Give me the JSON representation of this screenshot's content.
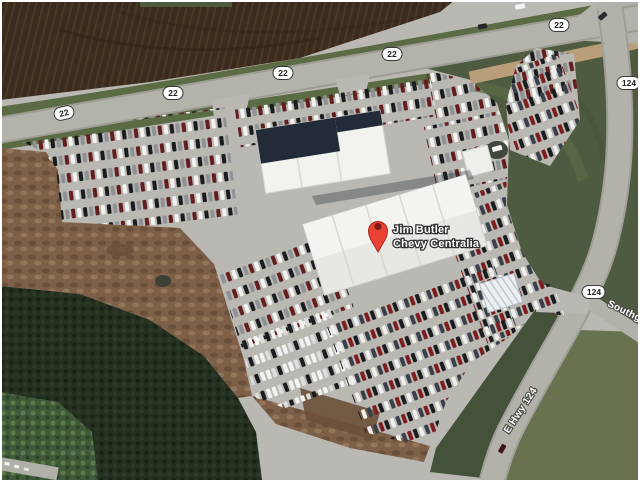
{
  "map": {
    "view_type": "satellite-map",
    "pin": {
      "label_line1": "Jim Butler",
      "label_line2": "Chevy Centralia",
      "color": "#ea4335"
    },
    "shields": [
      {
        "route": "22"
      },
      {
        "route": "22"
      },
      {
        "route": "22"
      },
      {
        "route": "22"
      },
      {
        "route": "22"
      },
      {
        "route": "124"
      },
      {
        "route": "124"
      }
    ],
    "road_names": [
      {
        "name": "Southgate"
      },
      {
        "name": "E Hwy 124"
      }
    ],
    "colors": {
      "field_brown": "#3b2b1d",
      "grass_green": "#52603e",
      "trees_dark": "#243020",
      "pavement": "#b9b8b2",
      "road": "#b1b1a9",
      "building_white": "#f0f0ec",
      "roof_dark": "#232b38",
      "pin_red": "#ea4335"
    }
  }
}
